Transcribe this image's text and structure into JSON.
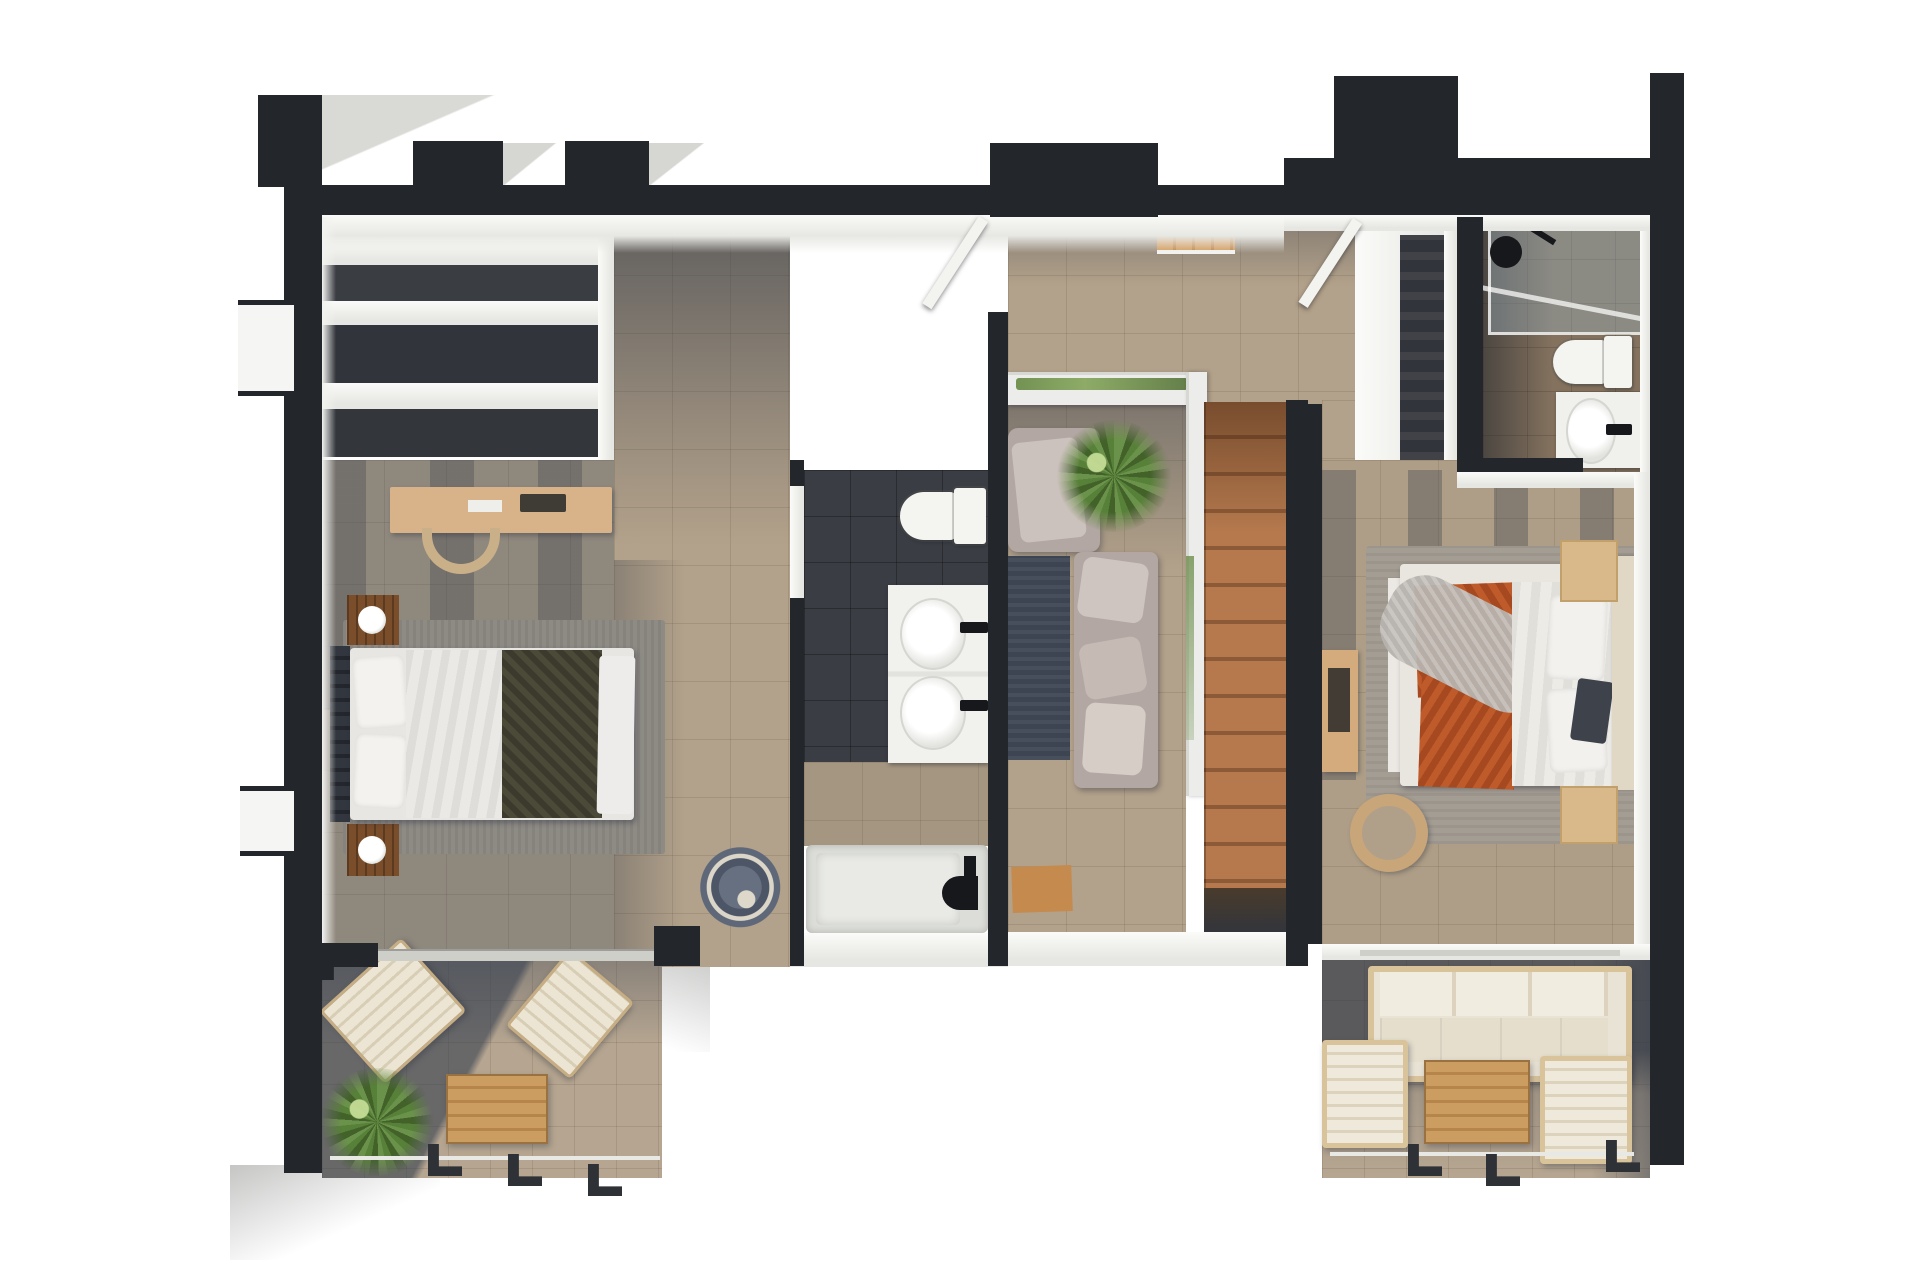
{
  "scene": {
    "title": "3D floor plan – upper floor, top-down architectural render",
    "view": "top-down axonometric",
    "background": "#ffffff"
  },
  "palette": {
    "bg": "#ffffff",
    "wall": "#23262b",
    "wallSoft": "#2d3036",
    "white": "#f4f4f2",
    "whiteShade": "#e0e0dc",
    "tileBeige": "#b3a28b",
    "slate": "#3a3d43",
    "slateDeep": "#31343a",
    "floorGray": "#8f887d",
    "shadow": "rgba(48,56,70,0.55)",
    "stairWood": "#a96f46",
    "stairWoodDark": "#8d5a37",
    "bridgeWood": "#cd9152",
    "deskWood": "#d8b288",
    "nightstandWood": "#7a4e2a",
    "lightWood": "#d9b98a",
    "oliveBlanket": "#4b4a38",
    "orangeBlanket": "#bf5b2b",
    "mauve": "#b3a7a3",
    "rugDark": "#3d4553",
    "rugGray": "#8e8b85",
    "rugTan": "#a49d93",
    "green": "#5d8238",
    "glass": "rgba(150,172,184,0.42)",
    "cream": "#e8e1d1",
    "tableWood": "#c3945c",
    "railing": "#2e3136",
    "tub": "#dcddd9"
  },
  "rooms": [
    {
      "id": "bedroom-left",
      "name": "Bedroom 1 (left) – desk, wardrobe shelves, double bed with olive blanket, 2 nightstands with lamps, rug, round lounge chair"
    },
    {
      "id": "hallway",
      "name": "Hallway – stone tile floor, open entry door"
    },
    {
      "id": "bathroom-center",
      "name": "Family bathroom – toilet, double-sink vanity, bathtub"
    },
    {
      "id": "landing",
      "name": "Landing lounge – armchair, sofa, palm plant, dark rug, glass balustrade, wooden staircase and bridge"
    },
    {
      "id": "bedroom-right",
      "name": "Bedroom 2 (right) – double bed with orange blanket, 2 nightstands, desk, round chair, wardrobe"
    },
    {
      "id": "bathroom-ensuite",
      "name": "En-suite bathroom – walk-in shower with glass screen, toilet, sink vanity"
    },
    {
      "id": "terrace-left",
      "name": "Left terrace – 2 sun loungers, wooden side table, palm plant, railing"
    },
    {
      "id": "terrace-right",
      "name": "Right terrace – outdoor sofa, 2 armchairs, wooden coffee table, railing"
    }
  ],
  "counts": {
    "bedrooms": 2,
    "bathrooms": 2,
    "terraces": 2,
    "staircases": 1,
    "beds": 2,
    "sinks": 3,
    "toilets": 2,
    "bathtubs": 1,
    "showers": 1,
    "plants": 3
  }
}
